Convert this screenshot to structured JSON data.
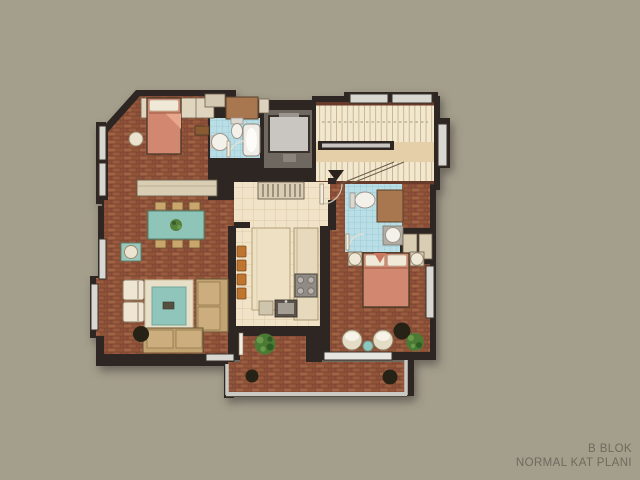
{
  "caption": {
    "line1": "B BLOK",
    "line2": "NORMAL KAT PLANI"
  },
  "palette": {
    "background": "#a49e8c",
    "wall": "#2f2823",
    "wood_floor": "#9a5a3e",
    "tile_floor": "#f0e3c7",
    "bath_tile": "#badee6",
    "stair_floor": "#f2e7cf",
    "stair_landing": "#e5cfa8",
    "stair_rail_trim": "#6b3a2a",
    "bed": "#d2886f",
    "pillow": "#f0e9d8",
    "sofa": "#c2a372",
    "rug_border": "#e8dfc8",
    "accent_teal": "#8fc5ba",
    "plant_green": "#4c7a36",
    "cabinet_brown": "#a9774f",
    "closet_beige": "#d9cdb4",
    "stool_orange": "#c0742e",
    "elevator_floor": "#6e6861",
    "elevator_car": "#c9c6c1",
    "stove_gray": "#908b84",
    "window_glass": "#d8d7d2",
    "railing": "#cbc9c3",
    "black_furniture": "#262019",
    "caption_text": "#6f6a5e"
  }
}
